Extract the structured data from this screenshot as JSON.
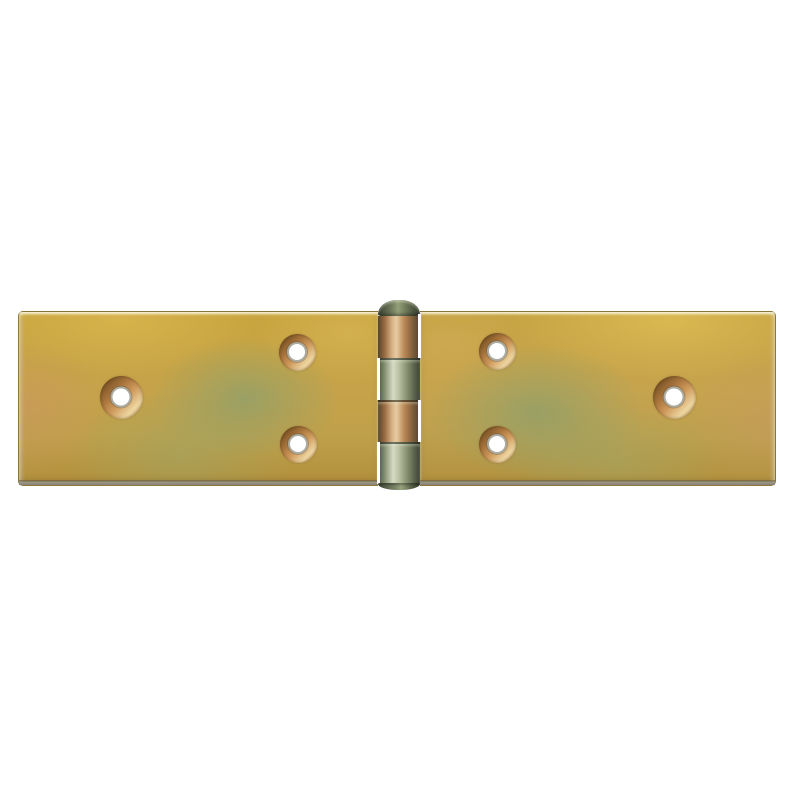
{
  "scene": {
    "type": "product-photo",
    "description": "Yellow zinc-plated wide backflap butt hinge, opened flat, viewed from above, centered on a plain white background",
    "background": "#ffffff"
  },
  "hinge": {
    "object": "wide butt hinge (backflap / table hinge)",
    "finish": "yellow passivated zinc plating with iridescent gold, olive-green, pink and copper sheen",
    "colors": {
      "background": "#ffffff",
      "gold": "#c9a53e",
      "gold_light": "#d8bf62",
      "olive": "#a5a96d",
      "sage_green": "#9fae7c",
      "tan": "#c39b55",
      "pink_tint": "#c99a72",
      "edge_dark": "#7a6a3a",
      "edge_steel": "#9c968a",
      "copper": "#a8743c",
      "copper_dark": "#6e4b1f",
      "copper_light": "#eed7a2",
      "bore_ring": "#b5b5aa",
      "hole_white": "#ffffff",
      "barrel_steel": "#93a078",
      "barrel_steel_light": "#d6dbc4",
      "barrel_steel_dark": "#4c5240",
      "barrel_copper": "#bb8a57",
      "barrel_copper_light": "#e6cba2",
      "cap_dark": "#39402f"
    },
    "leaves": [
      {
        "side": "left",
        "hole_count": 3
      },
      {
        "side": "right",
        "hole_count": 3
      }
    ],
    "holes": [
      {
        "id": "left-outer",
        "cx": 121,
        "cy": 397,
        "outer": 43,
        "inner": 17
      },
      {
        "id": "left-top",
        "cx": 297,
        "cy": 352,
        "outer": 37,
        "inner": 16
      },
      {
        "id": "left-bottom",
        "cx": 298,
        "cy": 444,
        "outer": 37,
        "inner": 16
      },
      {
        "id": "right-top",
        "cx": 497,
        "cy": 351,
        "outer": 37,
        "inner": 16
      },
      {
        "id": "right-bottom",
        "cx": 497,
        "cy": 444,
        "outer": 37,
        "inner": 16
      },
      {
        "id": "right-outer",
        "cx": 674,
        "cy": 397,
        "outer": 43,
        "inner": 17
      }
    ],
    "barrel": {
      "pin_head": "domed cap at top of barrel",
      "knuckle_count": 4,
      "knuckles": [
        {
          "index": 1,
          "tint": "copper",
          "gap": "right"
        },
        {
          "index": 2,
          "tint": "steel",
          "gap": "left"
        },
        {
          "index": 3,
          "tint": "copper",
          "gap": "right"
        },
        {
          "index": 4,
          "tint": "steel",
          "gap": "left"
        }
      ]
    }
  }
}
